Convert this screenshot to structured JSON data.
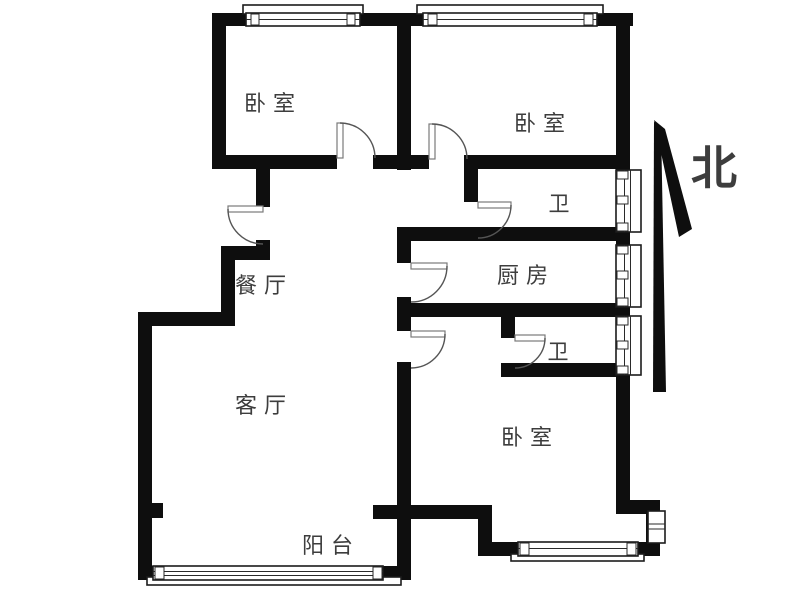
{
  "floorplan": {
    "background": "#ffffff",
    "wall_color": "#0e0e0e",
    "label_color": "#3d3d3d",
    "north_label": "北",
    "rooms": [
      {
        "name": "bedroom-northwest",
        "label": "卧室"
      },
      {
        "name": "bedroom-northeast",
        "label": "卧室"
      },
      {
        "name": "bathroom-north",
        "label": "卫"
      },
      {
        "name": "kitchen",
        "label": "厨房"
      },
      {
        "name": "dining-room",
        "label": "餐厅"
      },
      {
        "name": "bathroom-south",
        "label": "卫"
      },
      {
        "name": "living-room",
        "label": "客厅"
      },
      {
        "name": "bedroom-southeast",
        "label": "卧室"
      },
      {
        "name": "balcony",
        "label": "阳台"
      }
    ]
  }
}
